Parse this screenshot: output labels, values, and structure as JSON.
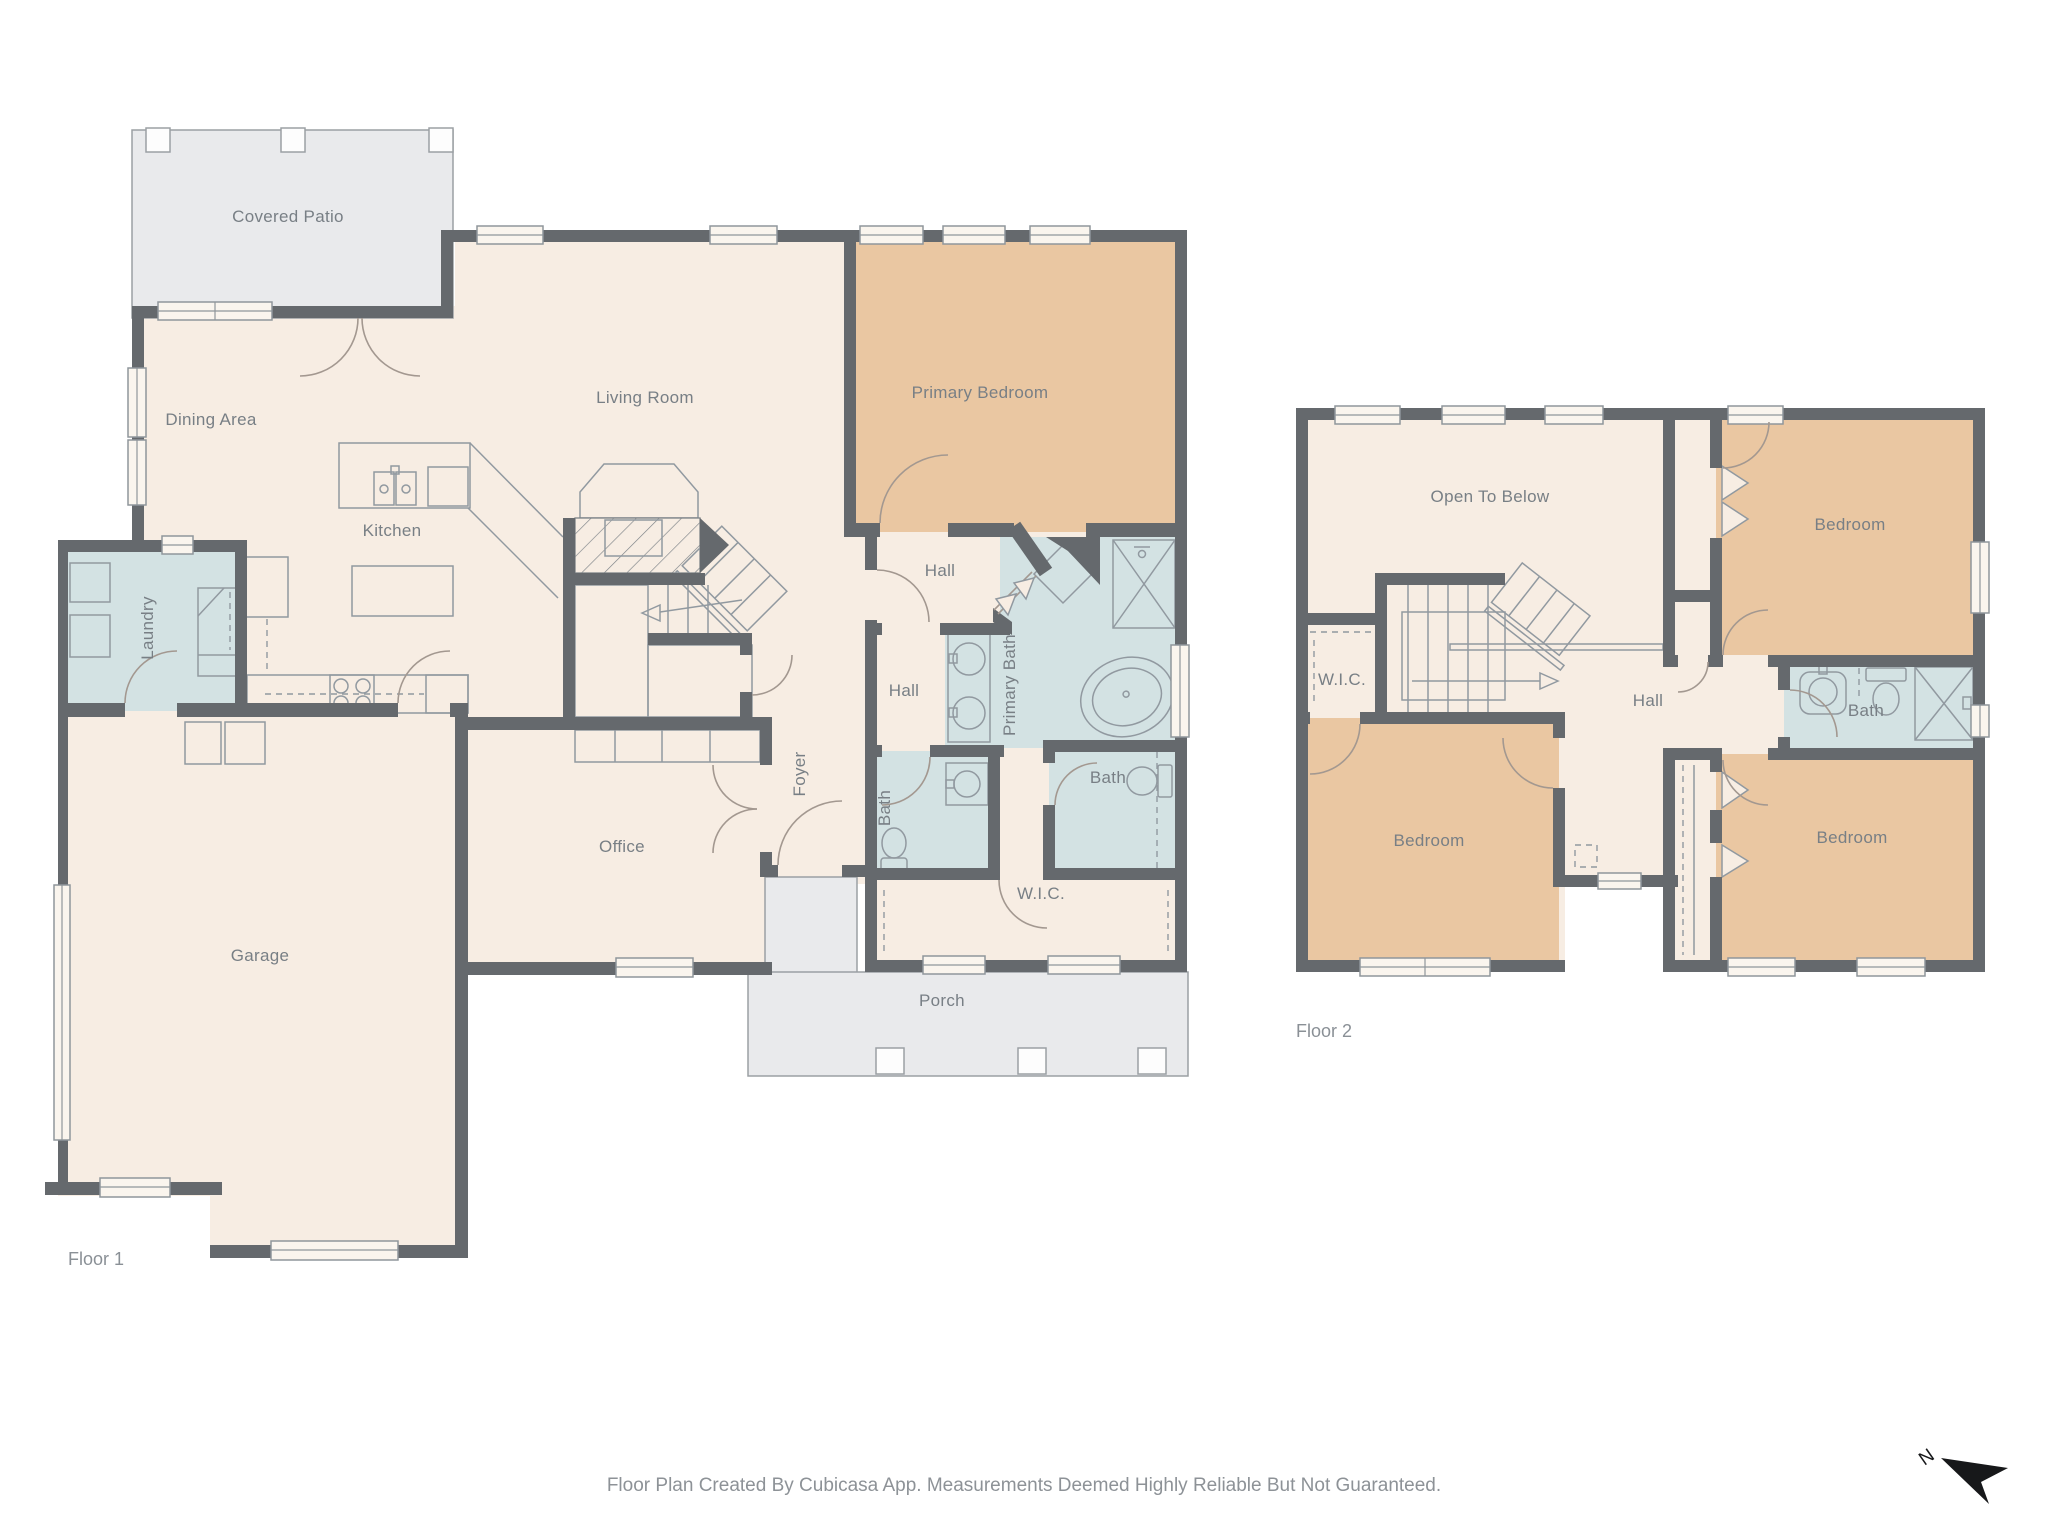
{
  "meta": {
    "footer_text": "Floor Plan Created By Cubicasa App. Measurements Deemed Highly Reliable But Not Guaranteed.",
    "compass": {
      "label": "N"
    },
    "colors": {
      "room_fill": "#f7ede3",
      "bedroom_fill": "#eac7a2",
      "bath_fill": "#d3e2e3",
      "outdoor_fill": "#e9eaec",
      "wall": "#65696d",
      "label_text": "#787f85"
    }
  },
  "floor1": {
    "label": "Floor 1",
    "rooms": [
      {
        "id": "covered-patio",
        "label": "Covered Patio"
      },
      {
        "id": "dining-area",
        "label": "Dining Area"
      },
      {
        "id": "living-room",
        "label": "Living Room"
      },
      {
        "id": "primary-bedroom",
        "label": "Primary Bedroom"
      },
      {
        "id": "kitchen",
        "label": "Kitchen"
      },
      {
        "id": "laundry",
        "label": "Laundry"
      },
      {
        "id": "hall-upper",
        "label": "Hall"
      },
      {
        "id": "hall-lower",
        "label": "Hall"
      },
      {
        "id": "primary-bath",
        "label": "Primary Bath"
      },
      {
        "id": "foyer",
        "label": "Foyer"
      },
      {
        "id": "bath-left",
        "label": "Bath"
      },
      {
        "id": "bath-right",
        "label": "Bath"
      },
      {
        "id": "office",
        "label": "Office"
      },
      {
        "id": "garage",
        "label": "Garage"
      },
      {
        "id": "wic",
        "label": "W.I.C."
      },
      {
        "id": "porch",
        "label": "Porch"
      }
    ]
  },
  "floor2": {
    "label": "Floor 2",
    "rooms": [
      {
        "id": "open-to-below",
        "label": "Open To Below"
      },
      {
        "id": "wic",
        "label": "W.I.C."
      },
      {
        "id": "hall",
        "label": "Hall"
      },
      {
        "id": "bedroom-top-right",
        "label": "Bedroom"
      },
      {
        "id": "bath",
        "label": "Bath"
      },
      {
        "id": "bedroom-bottom-left",
        "label": "Bedroom"
      },
      {
        "id": "bedroom-bottom-right",
        "label": "Bedroom"
      }
    ]
  }
}
